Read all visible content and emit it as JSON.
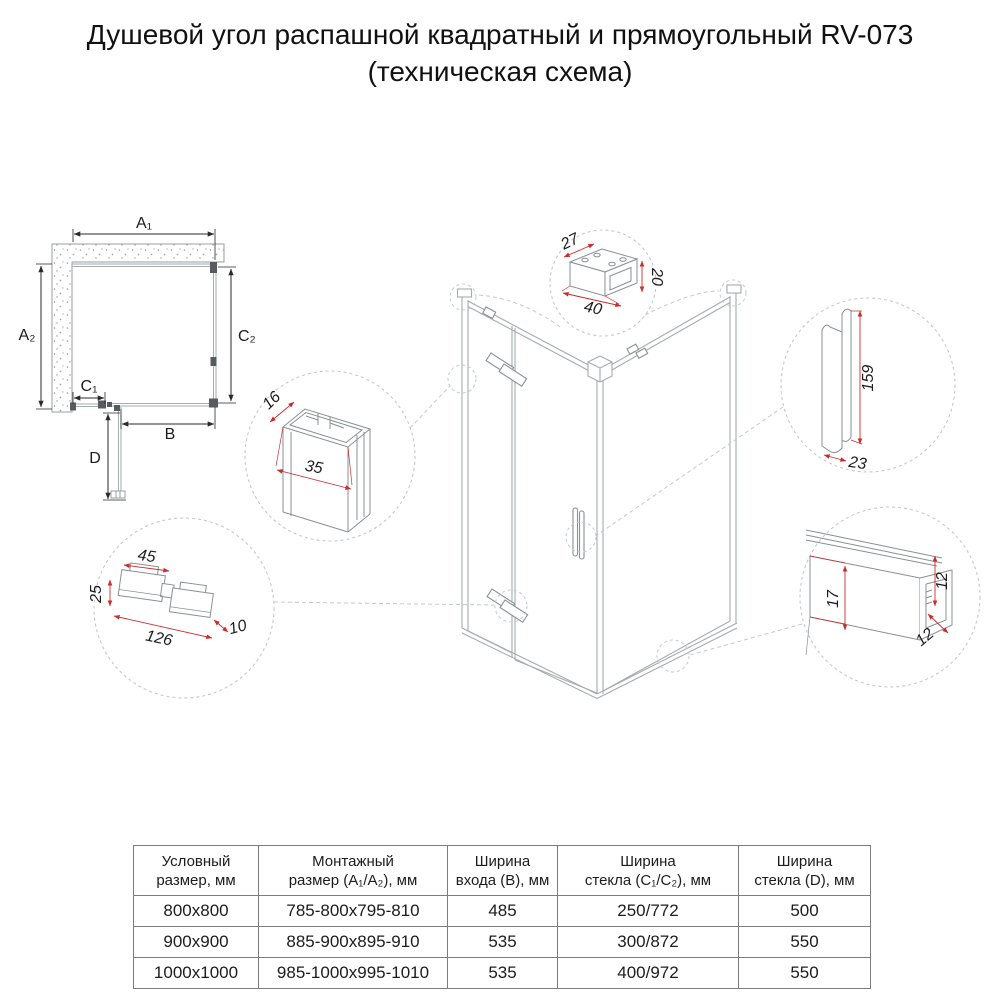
{
  "title": {
    "line1": "Душевой угол распашной квадратный и прямоугольный RV-073",
    "line2": "(техническая схема)"
  },
  "plan": {
    "labels": {
      "a1": "A₁",
      "a2": "A₂",
      "c1": "C₁",
      "c2": "C₂",
      "b": "B",
      "d": "D"
    }
  },
  "details": {
    "wall_bracket": {
      "depth": "27",
      "height": "20",
      "width": "40"
    },
    "wall_profile": {
      "depth": "16",
      "width": "35"
    },
    "handle": {
      "height": "159",
      "width": "23"
    },
    "hinge": {
      "top_width": "45",
      "height": "25",
      "length": "126",
      "thickness": "10"
    },
    "bottom_rail": {
      "inner_height": "17",
      "height": "12",
      "depth": "12"
    }
  },
  "table": {
    "headers": [
      {
        "line1": "Условный",
        "line2": "размер, мм"
      },
      {
        "line1": "Монтажный",
        "line2": "размер (A₁/A₂), мм"
      },
      {
        "line1": "Ширина",
        "line2": "входа (B), мм"
      },
      {
        "line1": "Ширина",
        "line2": "стекла (C₁/C₂), мм"
      },
      {
        "line1": "Ширина",
        "line2": "стекла (D), мм"
      }
    ],
    "rows": [
      [
        "800x800",
        "785-800x795-810",
        "485",
        "250/772",
        "500"
      ],
      [
        "900x900",
        "885-900x895-910",
        "535",
        "300/872",
        "550"
      ],
      [
        "1000x1000",
        "985-1000x995-1010",
        "535",
        "400/972",
        "550"
      ]
    ]
  },
  "colors": {
    "dimension_red": "#cc2b2b",
    "line_gray": "#a6abae",
    "text_black": "#1c1c1c"
  }
}
